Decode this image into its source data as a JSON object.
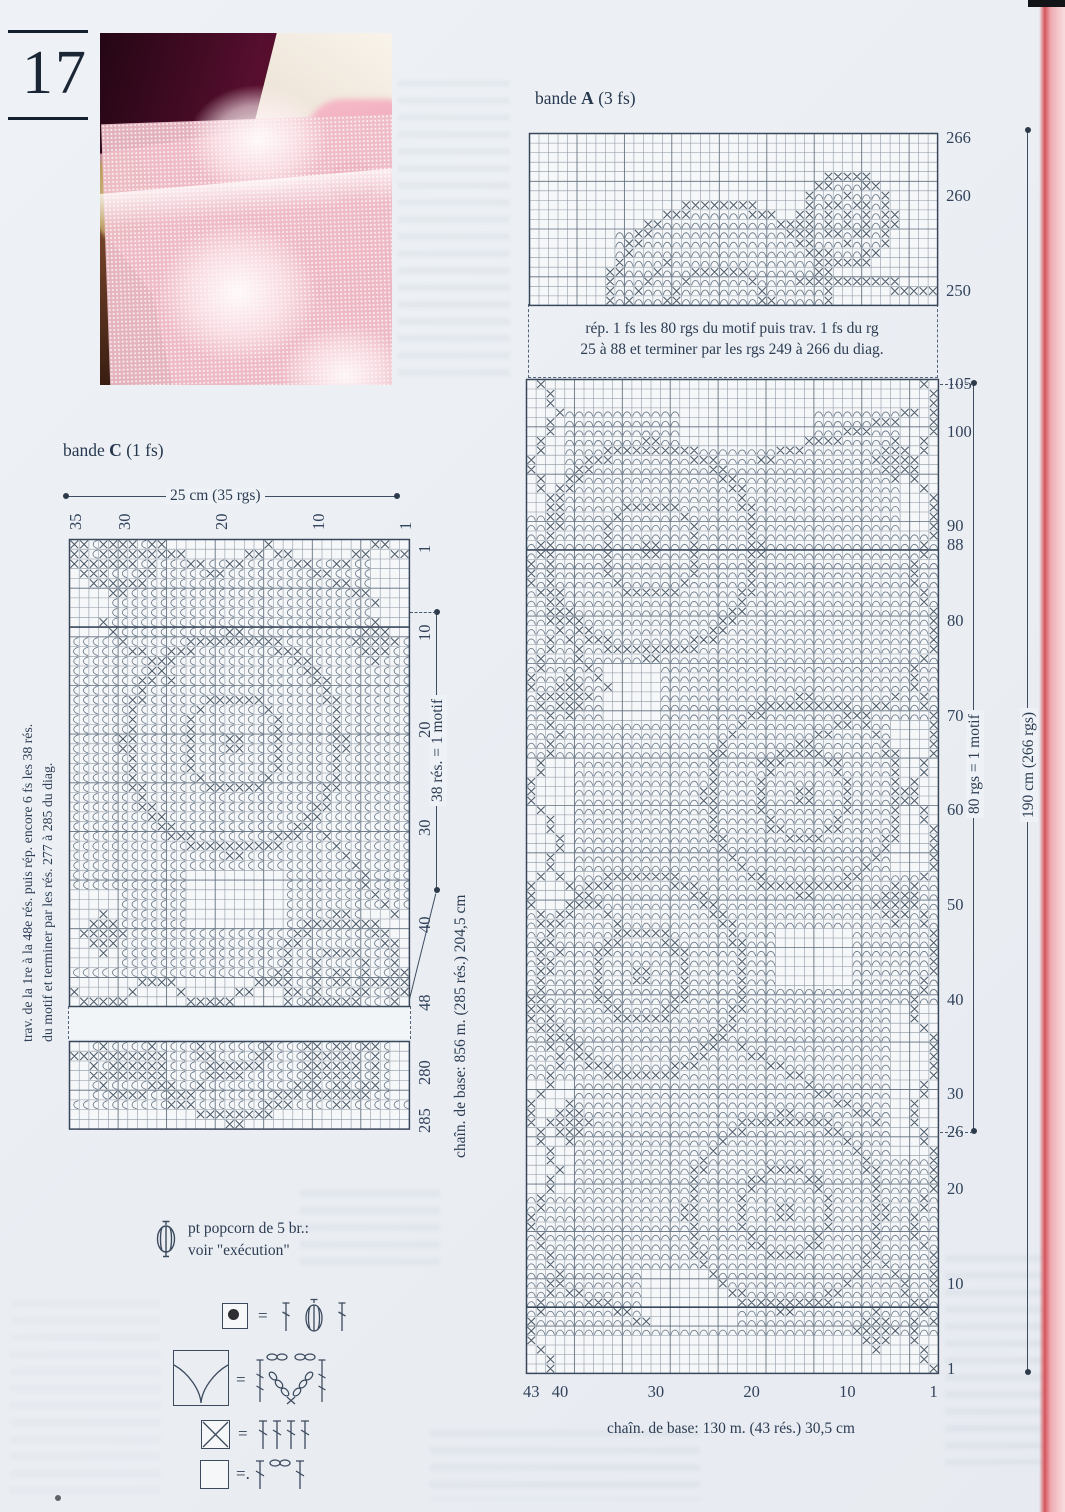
{
  "page": {
    "number": "17"
  },
  "photo": {
    "alt": "pink filet crochet lace bedspread with rose motifs"
  },
  "band_a": {
    "word": "bande",
    "letter": "A",
    "fs": "(3 fs)",
    "rep1": "rép. 1 fs les 80 rgs du motif puis trav. 1 fs du rg",
    "rep2": "25 à 88 et terminer par les rgs 249 à 266 du diag.",
    "dim_motif": "80 rgs = 1 motif",
    "dim_total": "190 cm (266 rgs)",
    "caption": "chaîn. de base: 130 m. (43 rés.) 30,5 cm"
  },
  "band_c": {
    "word": "bande",
    "letter": "C",
    "fs": "(1 fs)",
    "dim_width": "25 cm (35 rgs)",
    "dim_motif": "38 rés. = 1 motif",
    "caption": "chaîn. de base: 856 m. (285 rés.) 204,5 cm",
    "note1": "trav. de la 1re à la 48e rés. puis rép. encore 6 fs les 38 rés.",
    "note2": "du motif et terminer par les rés. 277 à 285 du diag."
  },
  "legend": {
    "popcorn1": "pt popcorn de 5 br.:",
    "popcorn2": "voir \"exécution\"",
    "eq": "=",
    "eq_dot": "=."
  },
  "colors": {
    "page_bg": "#eef2f6",
    "chart_bg": "#f5f7f9",
    "grid": "#8a95a2",
    "grid_bold": "#5f6d7d",
    "border": "#39475a",
    "x": "#4e5c6a",
    "arc": "#6d7b89",
    "ink": "#23344a",
    "edge_pink": "#f0b9bf",
    "edge_red": "#d4555c"
  },
  "charts": {
    "a_top": {
      "name": "chart-band-a-top",
      "x": 528,
      "y": 132,
      "cols": 43,
      "rows": 18,
      "cw": 9.49,
      "ch": 9.55,
      "top_row": 266,
      "row_labels": [
        266,
        260,
        250
      ],
      "arc_dir": "v",
      "motifs": [
        {
          "x": 20,
          "y": 19.5,
          "r": 12
        },
        {
          "x": 33.5,
          "y": 9,
          "r": 4.5
        }
      ],
      "stems": [
        [
          28,
          15,
          38,
          15
        ],
        [
          38,
          16,
          42,
          16
        ],
        [
          10,
          17,
          14,
          13
        ]
      ],
      "arc_bands": [
        [
          10,
          16,
          9,
          30
        ]
      ]
    },
    "a_main": {
      "name": "chart-band-a-main",
      "x": 525,
      "y": 378,
      "cols": 43,
      "rows": 105,
      "cw": 9.58,
      "ch": 9.466,
      "top_row": 105,
      "row_labels": [
        105,
        100,
        90,
        88,
        80,
        70,
        60,
        50,
        40,
        30,
        26,
        20,
        10,
        1
      ],
      "col_labels": [
        43,
        40,
        30,
        20,
        10,
        1
      ],
      "thick_rows": [
        88,
        8
      ],
      "guides": [
        {
          "row": 105,
          "to": 973
        },
        {
          "row": 26,
          "to": 973
        }
      ],
      "arc_dir": "v",
      "arc_fill": true,
      "motifs": [
        {
          "x": 13,
          "y": 18,
          "r": 11
        },
        {
          "x": 29,
          "y": 44,
          "r": 10
        },
        {
          "x": 12,
          "y": 63,
          "r": 10.5
        },
        {
          "x": 27,
          "y": 88,
          "r": 10
        }
      ],
      "stems": [
        [
          24,
          8,
          40,
          3
        ],
        [
          2,
          25,
          8,
          32
        ],
        [
          38,
          33,
          24,
          40
        ],
        [
          3,
          52,
          10,
          58
        ],
        [
          22,
          70,
          36,
          78
        ],
        [
          2,
          95,
          12,
          99
        ],
        [
          36,
          92,
          42,
          99
        ]
      ],
      "leaves": [
        {
          "x": 38,
          "y": 8,
          "s": 2
        },
        {
          "x": 4,
          "y": 33,
          "s": 2
        },
        {
          "x": 38,
          "y": 55,
          "s": 2
        },
        {
          "x": 4,
          "y": 78,
          "s": 2
        },
        {
          "x": 36,
          "y": 100,
          "s": 2
        }
      ],
      "vines": [
        {
          "col": 1.4,
          "amp": 1.2
        },
        {
          "col": 41.3,
          "amp": 1.2
        }
      ],
      "plain_patches": [
        [
          0,
          0,
          43,
          3
        ],
        [
          0,
          101,
          43,
          105
        ],
        [
          0,
          3,
          4,
          14
        ],
        [
          39,
          3,
          43,
          16
        ],
        [
          16,
          0,
          30,
          7
        ],
        [
          0,
          40,
          5,
          56
        ],
        [
          38,
          36,
          43,
          52
        ],
        [
          0,
          74,
          5,
          86
        ],
        [
          38,
          66,
          43,
          82
        ],
        [
          8,
          30,
          14,
          36
        ],
        [
          26,
          58,
          34,
          64
        ],
        [
          12,
          94,
          22,
          100
        ]
      ]
    },
    "c1": {
      "name": "chart-band-c-main",
      "x": 68,
      "y": 538,
      "cols": 35,
      "rows": 48,
      "cw": 9.71,
      "ch": 9.73,
      "row_dir": "down",
      "first_row": 1,
      "label_rot": true,
      "col_label_rot": true,
      "row_labels": [
        1,
        10,
        20,
        30,
        40,
        48
      ],
      "col_labels": [
        35,
        30,
        20,
        10,
        1
      ],
      "thick_rows": [
        10
      ],
      "arc_dir": "h",
      "arc_fill": true,
      "motifs": [
        {
          "x": 17,
          "y": 21,
          "r": 11
        },
        {
          "x": 5,
          "y": 1,
          "r": 4
        },
        {
          "x": 28,
          "y": 45,
          "r": 6
        }
      ],
      "stems": [
        [
          3,
          8,
          10,
          14
        ],
        [
          26,
          30,
          33,
          38
        ],
        [
          24,
          2,
          31,
          6
        ]
      ],
      "leaves": [
        {
          "x": 3,
          "y": 40,
          "s": 2
        },
        {
          "x": 31,
          "y": 10,
          "s": 2
        }
      ],
      "hvines": [
        {
          "row": 1.5,
          "amp": 1.1
        },
        {
          "row": 46.2,
          "amp": 1.1
        }
      ],
      "plain_patches": [
        [
          0,
          0,
          35,
          2
        ],
        [
          0,
          45,
          35,
          48
        ],
        [
          0,
          2,
          4,
          10
        ],
        [
          31,
          2,
          35,
          10
        ],
        [
          12,
          34,
          22,
          40
        ],
        [
          0,
          36,
          5,
          44
        ],
        [
          30,
          38,
          35,
          44
        ]
      ]
    },
    "c2": {
      "name": "chart-band-c-end",
      "x": 68,
      "y": 1040,
      "cols": 35,
      "rows": 9,
      "cw": 9.71,
      "ch": 9.73,
      "row_dir": "down",
      "first_row": 277,
      "label_rot": true,
      "row_labels": [
        280,
        285
      ],
      "arc_dir": "h",
      "arc_fill": true,
      "motifs": [
        {
          "x": 17,
          "y": -1,
          "r": 9
        },
        {
          "x": 6,
          "y": 2.5,
          "r": 3.2
        },
        {
          "x": 28,
          "y": 2.5,
          "r": 3.6
        }
      ],
      "stems": [
        [
          0,
          1,
          6,
          1
        ],
        [
          10,
          6,
          16,
          2
        ],
        [
          20,
          6,
          25,
          3
        ]
      ],
      "plain_patches": [
        [
          0,
          7,
          35,
          9
        ],
        [
          0,
          0,
          2,
          6
        ],
        [
          33,
          0,
          35,
          6
        ]
      ]
    }
  }
}
